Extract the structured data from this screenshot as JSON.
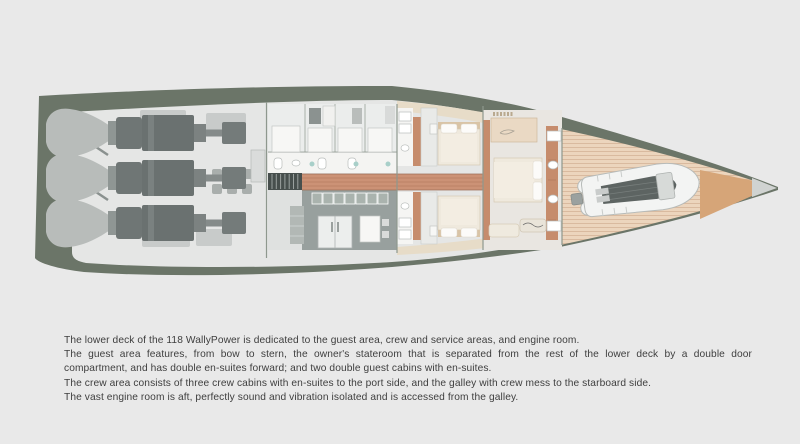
{
  "caption": {
    "lines": [
      "The lower deck of the 118 WallyPower is dedicated to the guest area, crew and service areas, and engine room.",
      "The guest area features, from bow to stern, the owner's stateroom that is separated from the rest of the lower deck by a double door",
      "compartment, and has double en-suites forward; and two double guest cabins with en-suites.",
      "The crew area consists of three crew cabins with en-suites to the port side, and the galley with crew mess to the starboard side.",
      "The vast engine room is aft, perfectly sound and vibration isolated and is accessed from the galley."
    ]
  },
  "colors": {
    "page-bg": "#e9e9e9",
    "text": "#3e3e3e",
    "hull": "#6b7568",
    "floor": "#e5e6e5",
    "wall": "#8e988e",
    "walkway": "#e7dcc8",
    "deck-wood": "#ecd5bd",
    "deck-line": "#d9ba9f",
    "tip-wood": "#d6a578",
    "tip-light": "#d0d3d1",
    "corridor-wood": "#cc9276",
    "corridor-line": "#b67d62",
    "accent-wood": "#c68c6c",
    "engine-light": "#b8bcba",
    "engine-dark": "#6f7675",
    "equip": "#c8cbca",
    "galley-floor": "#98a09e",
    "cabinet": "#aab3ae",
    "bed-beige": "#efe9dd",
    "bed-head": "#d9c4a6",
    "pillow": "#fcfbf9",
    "tender-floor": "#5d6462",
    "tender-tube": "#f3f4f3"
  }
}
